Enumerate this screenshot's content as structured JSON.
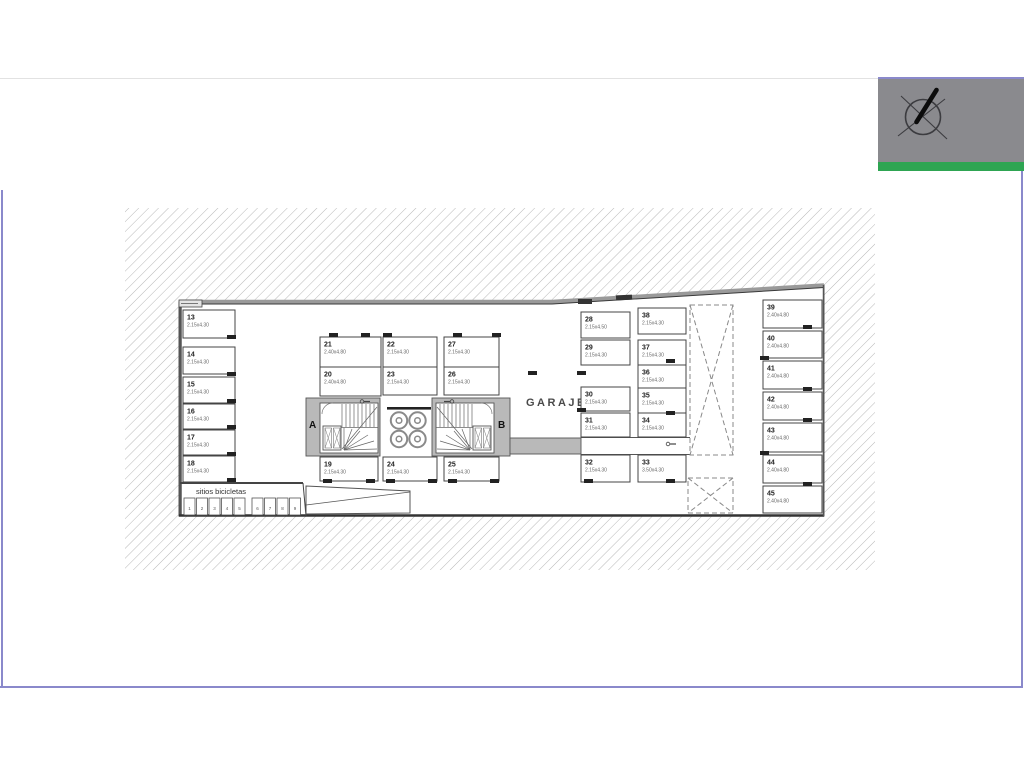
{
  "window": {
    "background": "#ffffff"
  },
  "frame": {
    "color": "#8a89cb"
  },
  "logo": {
    "background": "#8a8a8e",
    "stripe_color": "#2ea552",
    "icon": "compass-icon"
  },
  "plan": {
    "garaje_label": "GARAJE",
    "bike_area_label": "sitios bicicletas",
    "stair_core_a_label": "A",
    "stair_core_b_label": "B",
    "line_color": "#444444",
    "wall_gray": "#b9b9b9",
    "hatch_color": "#b0b0b0",
    "stalls": [
      {
        "num": "13",
        "dim": "2.15x4.30"
      },
      {
        "num": "14",
        "dim": "2.15x4.30"
      },
      {
        "num": "15",
        "dim": "2.15x4.30"
      },
      {
        "num": "16",
        "dim": "2.15x4.30"
      },
      {
        "num": "17",
        "dim": "2.15x4.30"
      },
      {
        "num": "18",
        "dim": "2.15x4.30"
      },
      {
        "num": "19",
        "dim": "2.15x4.30"
      },
      {
        "num": "20",
        "dim": "2.40x4.80"
      },
      {
        "num": "21",
        "dim": "2.40x4.80"
      },
      {
        "num": "22",
        "dim": "2.15x4.30"
      },
      {
        "num": "23",
        "dim": "2.15x4.30"
      },
      {
        "num": "24",
        "dim": "2.15x4.30"
      },
      {
        "num": "25",
        "dim": "2.15x4.30"
      },
      {
        "num": "26",
        "dim": "2.15x4.30"
      },
      {
        "num": "27",
        "dim": "2.15x4.30"
      },
      {
        "num": "28",
        "dim": "2.15x4.50"
      },
      {
        "num": "29",
        "dim": "2.15x4.30"
      },
      {
        "num": "30",
        "dim": "2.15x4.30"
      },
      {
        "num": "31",
        "dim": "2.15x4.30"
      },
      {
        "num": "32",
        "dim": "2.15x4.30"
      },
      {
        "num": "33",
        "dim": "3.50x4.30"
      },
      {
        "num": "34",
        "dim": "2.15x4.30"
      },
      {
        "num": "35",
        "dim": "2.15x4.30"
      },
      {
        "num": "36",
        "dim": "2.15x4.30"
      },
      {
        "num": "37",
        "dim": "2.15x4.30"
      },
      {
        "num": "38",
        "dim": "2.15x4.30"
      },
      {
        "num": "39",
        "dim": "2.40x4.80"
      },
      {
        "num": "40",
        "dim": "2.40x4.80"
      },
      {
        "num": "41",
        "dim": "2.40x4.80"
      },
      {
        "num": "42",
        "dim": "2.40x4.80"
      },
      {
        "num": "43",
        "dim": "2.40x4.80"
      },
      {
        "num": "44",
        "dim": "2.40x4.80"
      },
      {
        "num": "45",
        "dim": "2.40x4.80"
      }
    ],
    "bike_slot_numbers": [
      "1",
      "2",
      "3",
      "4",
      "5",
      "6",
      "7",
      "8",
      "9"
    ]
  }
}
